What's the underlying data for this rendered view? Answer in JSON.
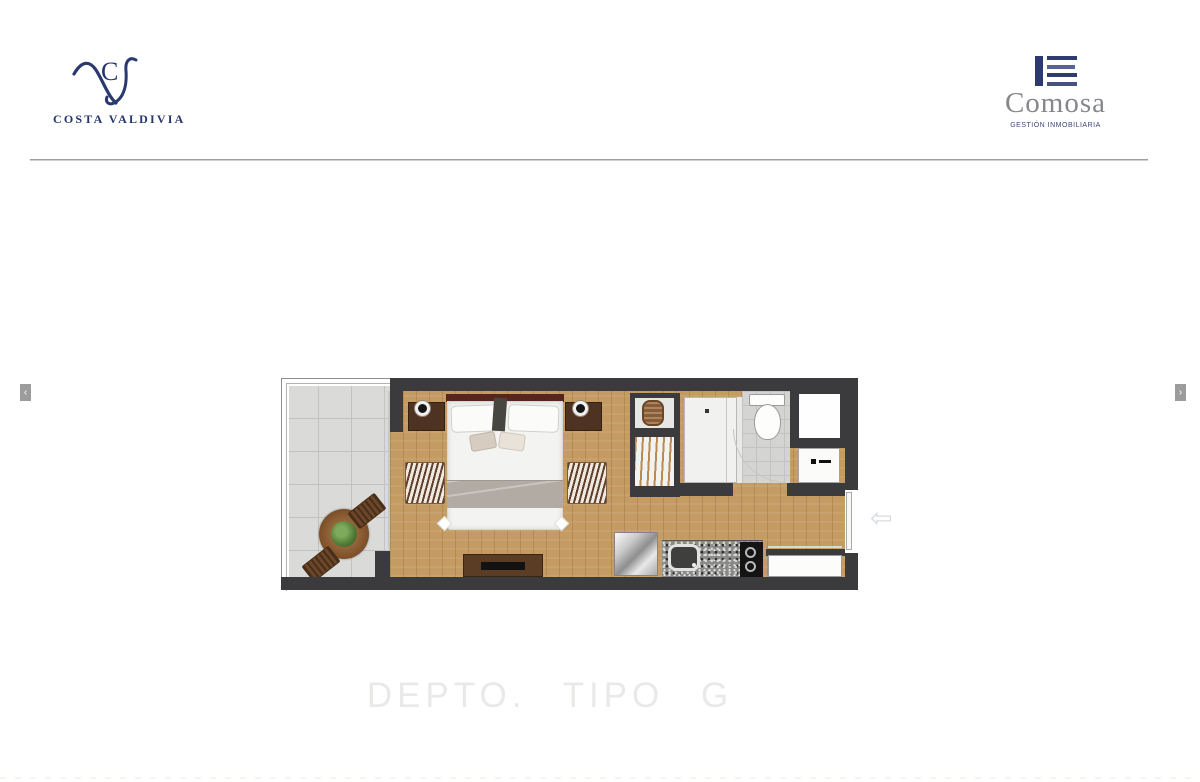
{
  "header": {
    "costa_valdivia": {
      "monogram": "C",
      "name": "COSTA VALDIVIA"
    },
    "comosa": {
      "name": "Comosa",
      "tagline": "GESTIÓN INMOBILIARIA"
    }
  },
  "carousel": {
    "prev": "‹",
    "next": "›",
    "pan_arrow": "⇦"
  },
  "plan": {
    "title": "DEPTO. TIPO G"
  },
  "colors": {
    "brand_navy": "#26356b",
    "comosa_text_gray": "#85878a",
    "wall_dark": "#3b3b3d",
    "wood_floor": "#c49b63",
    "balcony_tile": "#dadad8",
    "divider_gray": "#9e9e9e",
    "title_gray": "#e9e9e8",
    "nav_button_gray": "#9c9c9c"
  }
}
